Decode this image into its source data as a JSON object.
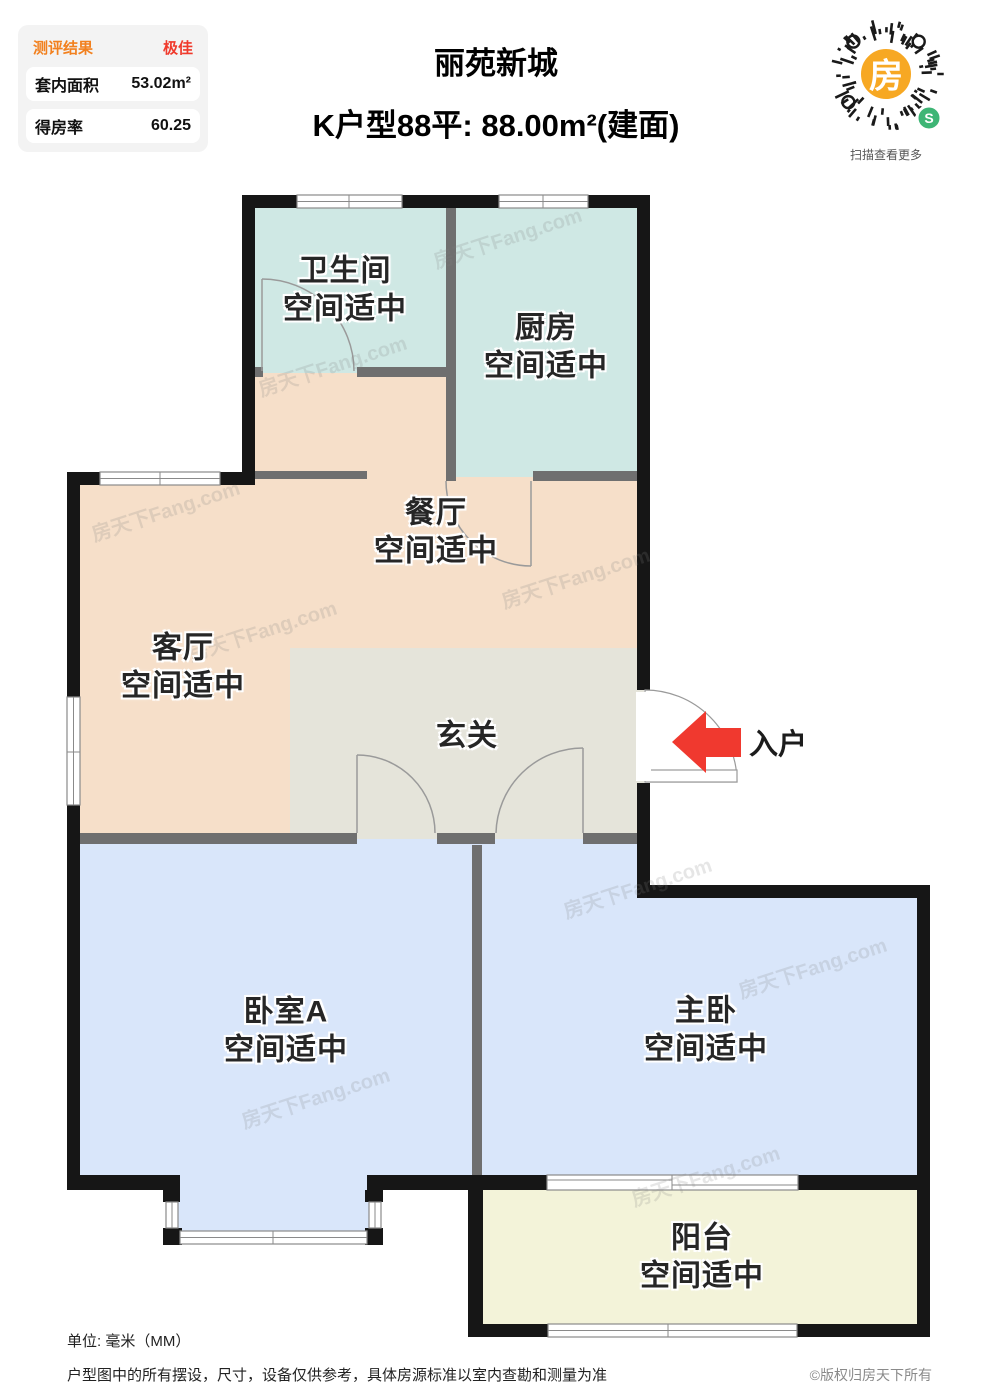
{
  "panel": {
    "result_label": "测评结果",
    "result_value": "极佳",
    "rows": [
      {
        "label": "套内面积",
        "value": "53.02m²"
      },
      {
        "label": "得房率",
        "value": "60.25"
      }
    ]
  },
  "header": {
    "title": "丽苑新城",
    "subtitle": "K户型88平: 88.00m²(建面)"
  },
  "qr": {
    "center_char": "房",
    "badge_char": "S",
    "caption": "扫描查看更多"
  },
  "rooms": {
    "bathroom": {
      "name": "卫生间",
      "note": "空间适中"
    },
    "kitchen": {
      "name": "厨房",
      "note": "空间适中"
    },
    "dining": {
      "name": "餐厅",
      "note": "空间适中"
    },
    "living": {
      "name": "客厅",
      "note": "空间适中"
    },
    "entry": {
      "name": "玄关"
    },
    "bedroomA": {
      "name": "卧室A",
      "note": "空间适中"
    },
    "master": {
      "name": "主卧",
      "note": "空间适中"
    },
    "balcony": {
      "name": "阳台",
      "note": "空间适中"
    }
  },
  "entrance_label": "入户",
  "watermark": "房天下Fang.com",
  "footer": {
    "unit": "单位: 毫米（MM）",
    "disclaimer": "户型图中的所有摆设，尺寸，设备仅供参考，具体房源标准以室内查勘和测量为准",
    "copyright": "©版权归房天下所有"
  },
  "colors": {
    "teal": "#cfe8e4",
    "peach": "#f6dfc9",
    "gray_room": "#e5e4da",
    "blue": "#d9e6fa",
    "yellow": "#f3f3d9",
    "wall": "#161616",
    "thin_wall": "#6f6f6f",
    "arrow_red": "#f0392f",
    "accent_orange": "#f2801e",
    "accent_red": "#f03a2c",
    "qr_orange": "#f7a823",
    "qr_green": "#3eb575"
  }
}
